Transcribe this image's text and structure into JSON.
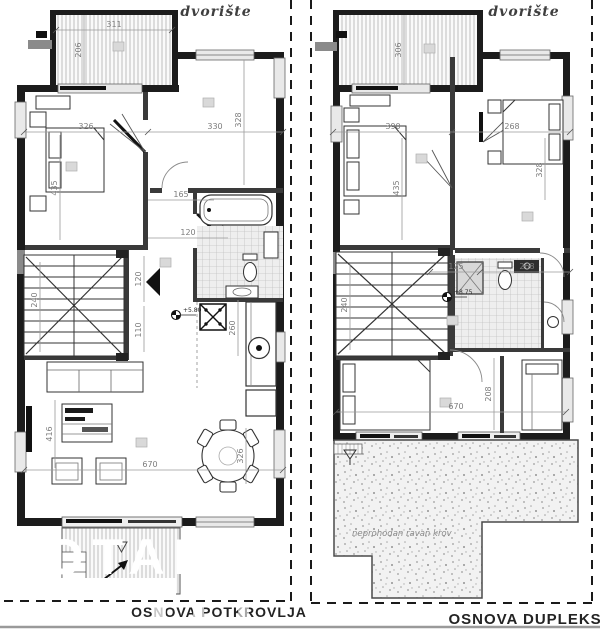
{
  "left_plan": {
    "yard_label": "dvorište",
    "caption": "OSNOVA POTKROVLJA",
    "level_text": "+5.80",
    "dims": {
      "terrace_w": "311",
      "terrace_d": "206",
      "bed1_w": "326",
      "bed1_d": "435",
      "room2_w": "330",
      "room2_d": "328",
      "bath_w": "165",
      "hall_w": "120",
      "stairs_w": "120",
      "flight": "110",
      "stairs_d": "240",
      "kitchen_d": "260",
      "living_w": "670",
      "dining_d": "326",
      "living_d": "416"
    }
  },
  "right_plan": {
    "yard_label": "dvorište",
    "caption": "OSNOVA DUPLEKSA",
    "roof_label": "neprohodan ravan krov",
    "level_text": "+8.75",
    "dims": {
      "terrace_d": "306",
      "bed1_w": "390",
      "bed1_d": "435",
      "bed2_w": "268",
      "bed2_d": "328",
      "hall_w": "125",
      "bath_w": "268",
      "stairs_d": "240",
      "room3_d": "208",
      "living_w": "670"
    }
  },
  "watermark": {
    "text": "TOTAL"
  }
}
